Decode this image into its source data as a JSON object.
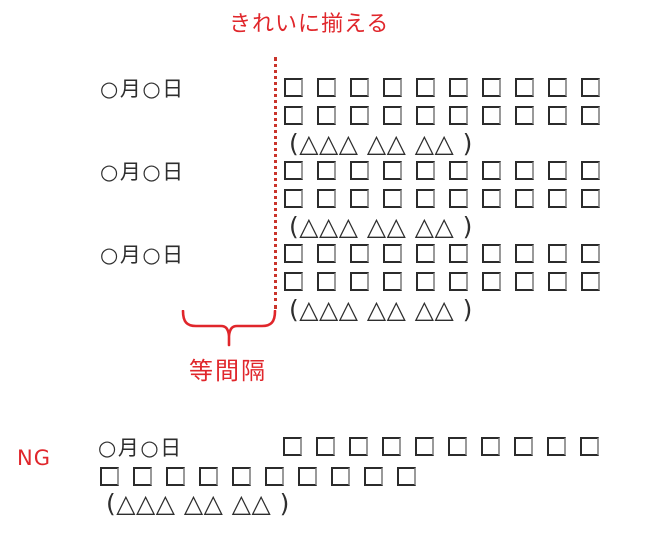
{
  "annotations": {
    "align_label": "きれいに揃える",
    "spacing_label": "等間隔",
    "ng_label": "NG",
    "accent_color": "#e0262b",
    "guide_line_color": "#c9342b"
  },
  "good_example": {
    "blocks": [
      {
        "date": "○月○日",
        "square_rows": [
          {
            "count": 10
          },
          {
            "count": 10
          }
        ],
        "caption": "(△△△ △△ △△ )"
      },
      {
        "date": "○月○日",
        "square_rows": [
          {
            "count": 10
          },
          {
            "count": 10
          }
        ],
        "caption": "(△△△ △△ △△ )"
      },
      {
        "date": "○月○日",
        "square_rows": [
          {
            "count": 10
          },
          {
            "count": 10
          }
        ],
        "caption": "(△△△ △△ △△ )"
      }
    ]
  },
  "ng_example": {
    "date": "○月○日",
    "square_rows": [
      {
        "count": 10
      },
      {
        "count": 10
      }
    ],
    "caption": "(△△△ △△ △△ )"
  }
}
